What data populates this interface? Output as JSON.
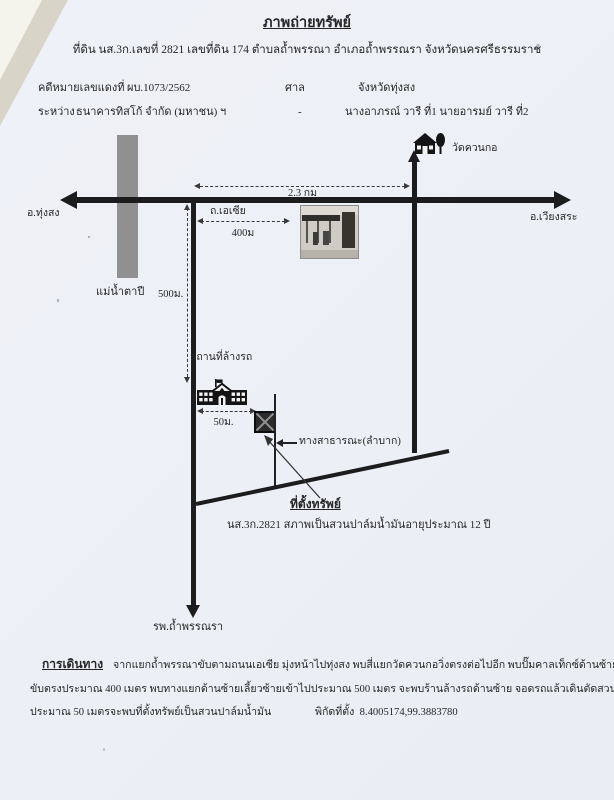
{
  "page": {
    "title": "ภาพถ่ายทรัพย์",
    "subtitle": "ที่ดิน นส.3ก.เลขที่ 2821 เลขที่ดิน 174 ตำบลถ้ำพรรณา อำเภอถ้ำพรรณรา จังหวัดนครศรีธรรมราช"
  },
  "case_info": {
    "case_no_label": "คดีหมายเลขแดงที่",
    "case_no_value": "ผบ.1073/2562",
    "court_label": "ศาล",
    "court_value": "จังหวัดทุ่งสง",
    "between_label": "ระหว่าง",
    "plaintiff": "ธนาคารทิสโก้ จำกัด (มหาชน) ฯ",
    "dash": "-",
    "defendant": "นางอาภรณ์ วารี ที่1 นายอารมย์ วารี ที่2"
  },
  "map": {
    "west_label": "อ.ทุ่งสง",
    "east_label": "อ.เวียงสระ",
    "river_label": "แม่น้ำตาปี",
    "distance_main": "2.3 กม",
    "asia_road_label": "ถ.เอเซีย",
    "distance_400": "400ม",
    "distance_500": "500ม.",
    "temple_label": "วัดควนกอ",
    "carwash_label": "สถานที่ล้างรถ",
    "distance_50": "50ม.",
    "public_way_label": "ทางสาธารณะ(ลำบาก)",
    "site_heading": "ที่ตั้งทรัพย์",
    "site_note": "นส.3ก.2821 สภาพเป็นสวนปาล์มน้ำมันอายุประมาณ 12 ปี",
    "hospital_label": "รพ.ถ้ำพรรณรา"
  },
  "directions": {
    "heading": "การเดินทาง",
    "line1": "จากแยกถ้ำพรรณาขับตามถนนเอเซีย มุ่งหน้าไปทุ่งสง พบสี่แยกวัดควนกอวิ่งตรงต่อไปอีก พบปั๊มคาลเท็กซ์ด้านซ้ายมือ",
    "line2": "ขับตรงประมาณ 400 เมตร พบทางแยกด้านซ้ายเลี้ยวซ้ายเข้าไปประมาณ 500 เมตร จะพบร้านล้างรถด้านซ้าย จอดรถแล้วเดินตัดสวนยางพาราไป",
    "line3": "ประมาณ 50 เมตรจะพบที่ตั้งทรัพย์เป็นสวนปาล์มน้ำมัน",
    "coords_label": "พิกัดที่ตั้ง",
    "coords_value": "8.4005174,99.3883780"
  },
  "colors": {
    "ink": "#1e1e1e",
    "river_gray": "#909090",
    "paper": "#eef1f7"
  }
}
